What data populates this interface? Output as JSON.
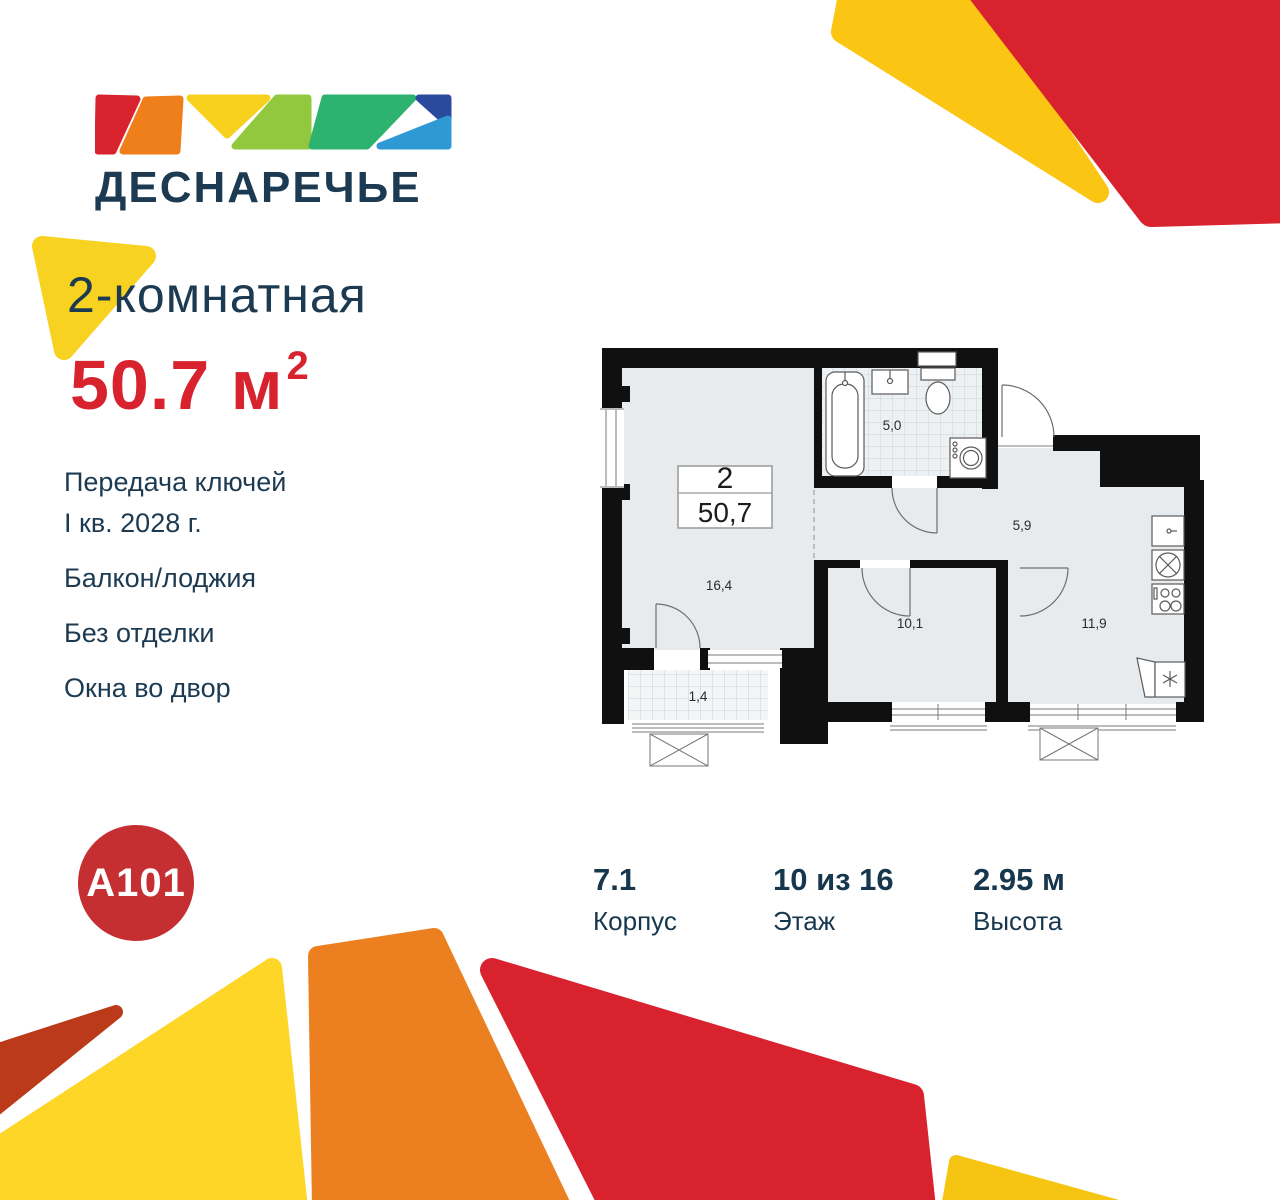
{
  "brand": {
    "name": "ДЕСНАРЕЧЬЕ",
    "developer": "A101"
  },
  "listing": {
    "title": "2-комнатная",
    "area_value": "50.7",
    "area_unit": "м",
    "area_sup": "2",
    "features": [
      "Передача ключей\nI кв. 2028 г.",
      "Балкон/лоджия",
      "Без отделки",
      "Окна во двор"
    ]
  },
  "floorplan": {
    "label_rooms": "2",
    "label_area": "50,7",
    "rooms": [
      {
        "name": "bathroom",
        "area": "5,0"
      },
      {
        "name": "hallway",
        "area": "5,9"
      },
      {
        "name": "living-room",
        "area": "16,4"
      },
      {
        "name": "bedroom",
        "area": "10,1"
      },
      {
        "name": "kitchen",
        "area": "11,9"
      },
      {
        "name": "balcony",
        "area": "1,4"
      }
    ]
  },
  "stats": [
    {
      "value": "7.1",
      "label": "Корпус"
    },
    {
      "value": "10 из 16",
      "label": "Этаж"
    },
    {
      "value": "2.95 м",
      "label": "Высота"
    }
  ],
  "colors": {
    "navy_text": "#1c3b52",
    "accent_red": "#d8232e",
    "a101_red": "#c62f31",
    "yellow": "#f7d221",
    "golden_yellow": "#fbc514",
    "bottom_yellow": "#fdd628",
    "orange": "#ec7f1f",
    "brick_red": "#bb3a1a",
    "logo_light_green": "#92c83e",
    "logo_teal_green": "#2eb270",
    "logo_dark_blue": "#2b4a9d",
    "logo_light_blue": "#2f99d4",
    "plan_floor": "#e7ebee",
    "plan_wall": "#101010"
  }
}
